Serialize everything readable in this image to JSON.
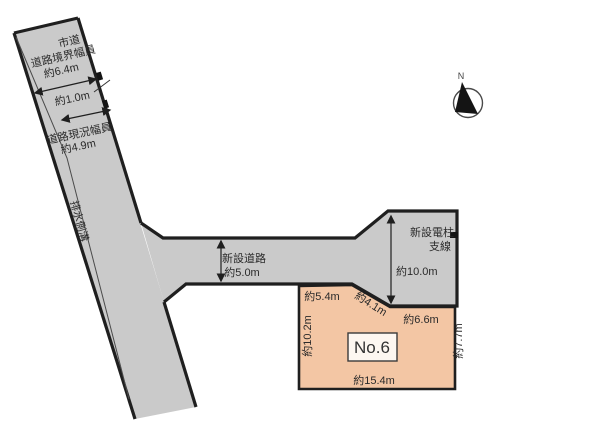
{
  "diagram": {
    "title_semantics": "land plot layout drawing",
    "city_road": {
      "name_label": "市道",
      "boundary_width_label": "道路境界幅員",
      "boundary_width_value": "約6.4m",
      "offset_value": "約1.0m",
      "current_width_label": "道路現況幅員",
      "current_width_value": "約4.9m",
      "gutter_label": "排水側溝"
    },
    "new_road": {
      "label": "新設道路",
      "width_value": "約5.0m",
      "pole_label_line1": "新設電柱",
      "pole_label_line2": "支線",
      "depth_value": "約10.0m"
    },
    "lot": {
      "number": "No.6",
      "edge_top_left": "約5.4m",
      "edge_diagonal": "約4.1m",
      "edge_top_right": "約6.6m",
      "edge_left": "約10.2m",
      "edge_bottom": "約15.4m",
      "edge_right": "約7.7m"
    },
    "compass": {
      "north_label": "N"
    },
    "colors": {
      "road_fill": "#cacaca",
      "lot_fill": "#f3c6a4",
      "lot_box_fill": "#fdf7f1",
      "line": "#1f1f1f"
    }
  }
}
